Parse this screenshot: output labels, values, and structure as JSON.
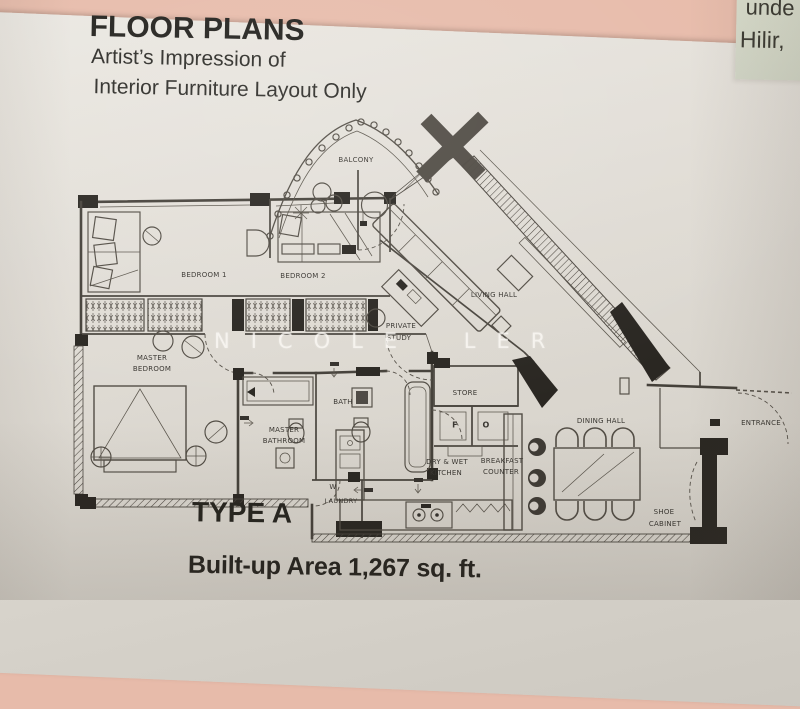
{
  "side_note": {
    "line1": "unde",
    "line2": "Hilir,"
  },
  "header": {
    "title": "FLOOR PLANS",
    "subtitle_line1": "Artist’s Impression of",
    "subtitle_line2": "Interior Furniture Layout Only"
  },
  "plan": {
    "watermark": "NICOLE LER",
    "rooms": {
      "balcony": "BALCONY",
      "bedroom1": "BEDROOM 1",
      "bedroom2": "BEDROOM 2",
      "master_bedroom_l1": "MASTER",
      "master_bedroom_l2": "BEDROOM",
      "private_study_l1": "PRIVATE",
      "private_study_l2": "STUDY",
      "living_hall": "LIVING HALL",
      "bath": "BATH",
      "master_bathroom_l1": "MASTER",
      "master_bathroom_l2": "BATHROOM",
      "store": "STORE",
      "fridge_abbr": "F",
      "oven_abbr": "O",
      "kitchen_l1": "DRY & WET",
      "kitchen_l2": "KITCHEN",
      "breakfast_l1": "BREAKFAST",
      "breakfast_l2": "COUNTER",
      "dining_hall": "DINING HALL",
      "entrance": "ENTRANCE",
      "shoe_cabinet_l1": "SHOE",
      "shoe_cabinet_l2": "CABINET",
      "washer": "W",
      "laundry": "LAUNDRY"
    }
  },
  "footer": {
    "type_label": "TYPE A",
    "area_label": "Built-up Area 1,267 sq. ft."
  },
  "colors": {
    "background_pink": "#e7bbaa",
    "paper": "#ddd8d1",
    "note_green": "#d7dbca",
    "ink": "#4a463f",
    "wall_black": "#2a2722",
    "watermark_white": "#fcfaf5"
  }
}
